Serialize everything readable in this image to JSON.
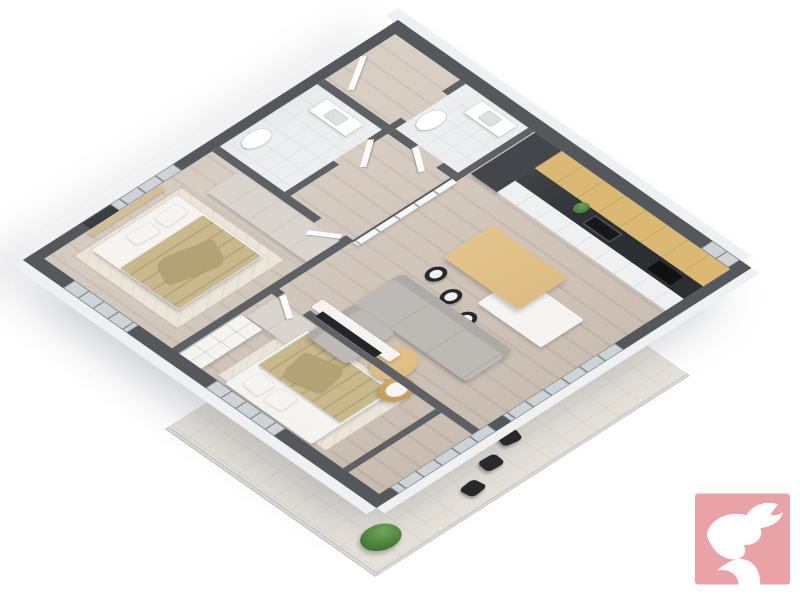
{
  "scene": {
    "title": "3D isometric floor-plan render of a two-bedroom apartment",
    "projection": "axonometric",
    "background": "#ffffff",
    "has_visible_text": false
  },
  "palette": {
    "wall_top": "#54585c",
    "wall_in": "#5d6165",
    "wall_face": "#eef0f1",
    "floor_wood_a": "#d3c6b9",
    "floor_wood_b": "#c8bab0",
    "tile_bath": "#eceeef",
    "tile_balcony": "#e6e2da",
    "rug": "#ece5da",
    "wardrobe": "#d9d5ce",
    "bed_white": "#f5f4f1",
    "blanket_tan": "#c8b88b",
    "throw_tan": "#b2a276",
    "sofa": "#bdb9b5",
    "sofa_dark": "#aeaaa6",
    "table_wood": "#dcbc82",
    "chair_black": "#26282b",
    "cabinet_wood": "#dcb972",
    "counter_dark": "#2b2e32",
    "cabinet_white": "#eef0f1",
    "fridge_dark": "#43464a",
    "glass": "#cdd3d6",
    "frame": "#868b8e",
    "door_white": "#fbfbfa",
    "partition_white": "#f6f7f7",
    "shelf_wood": "#d4bd93",
    "tv_dark": "#232529",
    "plant_green": "#49813a",
    "logo_pink": "#e9a3a7"
  },
  "rooms": [
    {
      "id": "entry-hall",
      "floor": "wood",
      "features": [
        "entry-door"
      ]
    },
    {
      "id": "bathroom-1",
      "floor": "tile",
      "features": [
        "vanity-sink",
        "toilet",
        "door"
      ]
    },
    {
      "id": "bathroom-2",
      "floor": "tile",
      "features": [
        "vanity-sink",
        "toilet",
        "door"
      ]
    },
    {
      "id": "kitchen",
      "floor": "wood",
      "features": [
        "tall-fridge",
        "wood-upper-cabinets",
        "dark-stone-countertop",
        "sink",
        "cooktop",
        "white-base-cabinets",
        "counter-plant"
      ]
    },
    {
      "id": "dining-area",
      "floor": "wood",
      "features": [
        "wood-dining-table",
        "white-island-extension",
        "black-dining-chairs-x3"
      ]
    },
    {
      "id": "living-room",
      "floor": "wood",
      "features": [
        "l-shaped-gray-sofa",
        "round-wood-coffee-tables-x2",
        "tv-bench",
        "wall-mounted-tv",
        "glazed-grid-partition"
      ]
    },
    {
      "id": "bedroom-1",
      "floor": "wood",
      "features": [
        "double-bed",
        "tan-blanket",
        "pillows",
        "area-rug",
        "wardrobe",
        "tv-wall-niche",
        "wood-wall-shelf",
        "window"
      ]
    },
    {
      "id": "bedroom-2",
      "floor": "wood",
      "features": [
        "double-bed",
        "tan-blanket",
        "pillows",
        "area-rug",
        "wardrobe",
        "open-cubby-shelf",
        "window"
      ]
    },
    {
      "id": "balcony",
      "floor": "tile",
      "features": [
        "black-outdoor-chairs-x3",
        "green-shrub",
        "parapet"
      ]
    }
  ],
  "logo": {
    "name": "dove-logo",
    "background": "#e9a3a7",
    "glyph": "white-dove-with-swoosh",
    "position": "bottom-right"
  }
}
